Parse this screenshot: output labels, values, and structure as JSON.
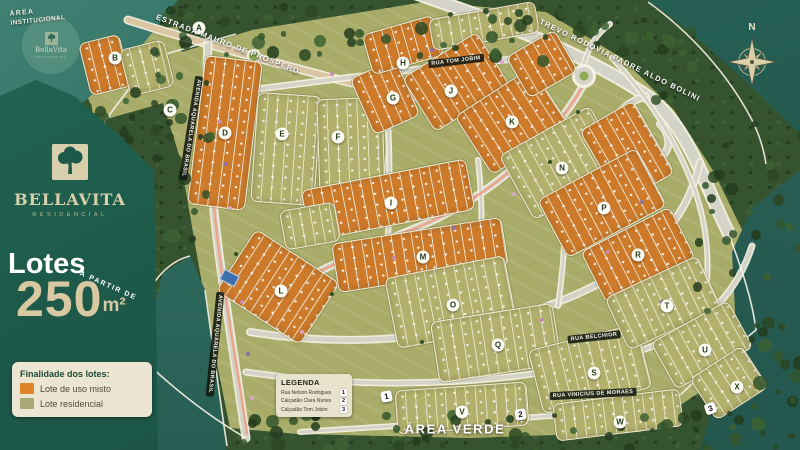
{
  "colors": {
    "panel_green": "#1d5848",
    "misto_orange": "#cd7a2b",
    "residencial_olive": "#b2b06c",
    "water_teal": "#2c685e",
    "cream": "#ece5d1",
    "beige_text": "#d9c9a2",
    "salmon_path": "#efa189"
  },
  "brand": {
    "name": "BellaVita",
    "subtitle": "RESIDENCIAL"
  },
  "offer": {
    "lead": "Lotes",
    "qualifier": "A PARTIR DE",
    "value": "250",
    "unit": "m²"
  },
  "finalidade": {
    "title": "Finalidade dos lotes:",
    "items": [
      {
        "label": "Lote de uso misto",
        "type": "misto"
      },
      {
        "label": "Lote residencial",
        "type": "residencial"
      }
    ]
  },
  "legenda": {
    "title": "LEGENDA",
    "items": [
      {
        "num": "1",
        "label": "Rua Nelson Rodrigues"
      },
      {
        "num": "2",
        "label": "Calçadão Clara Nunes"
      },
      {
        "num": "3",
        "label": "Calçadão Tom Jobim"
      }
    ]
  },
  "corner_labels": {
    "area_institucional_line1": "ÁREA",
    "area_institucional_line2": "INSTITUCIONAL",
    "area_verde": "ÁREA VERDE",
    "compass_north": "N"
  },
  "street_labels": [
    {
      "text": "ESTRADA MAURO DE PROSPERO",
      "x": 228,
      "y": 44,
      "rot": 21,
      "variant": "outline"
    },
    {
      "text": "TREVO RODOVIA PADRE ALDO BOLINI",
      "x": 620,
      "y": 60,
      "rot": 26,
      "variant": "outline"
    },
    {
      "text": "AVENIDA AQUARELA DO BRASIL",
      "x": 191,
      "y": 128,
      "rot": 99,
      "variant": "pill"
    },
    {
      "text": "AVENIDA AQUARELA DO BRASIL",
      "x": 215,
      "y": 344,
      "rot": 96,
      "variant": "pill"
    },
    {
      "text": "RUA TOM JOBIM",
      "x": 456,
      "y": 61,
      "rot": -7,
      "variant": "pill"
    },
    {
      "text": "RUA BELCHIOR",
      "x": 594,
      "y": 337,
      "rot": -6,
      "variant": "pill"
    },
    {
      "text": "RUA VINICIUS DE MORAES",
      "x": 593,
      "y": 394,
      "rot": -3,
      "variant": "pill"
    }
  ],
  "blocks": [
    {
      "letter": "A",
      "x": 199,
      "y": 28
    },
    {
      "letter": "B",
      "x": 115,
      "y": 58
    },
    {
      "letter": "C",
      "x": 170,
      "y": 110
    },
    {
      "letter": "D",
      "x": 225,
      "y": 133
    },
    {
      "letter": "E",
      "x": 282,
      "y": 134
    },
    {
      "letter": "F",
      "x": 338,
      "y": 137
    },
    {
      "letter": "G",
      "x": 393,
      "y": 98
    },
    {
      "letter": "H",
      "x": 403,
      "y": 63
    },
    {
      "letter": "I",
      "x": 391,
      "y": 203
    },
    {
      "letter": "J",
      "x": 451,
      "y": 91
    },
    {
      "letter": "K",
      "x": 512,
      "y": 122
    },
    {
      "letter": "L",
      "x": 281,
      "y": 291
    },
    {
      "letter": "M",
      "x": 423,
      "y": 257
    },
    {
      "letter": "N",
      "x": 562,
      "y": 168
    },
    {
      "letter": "O",
      "x": 453,
      "y": 305
    },
    {
      "letter": "P",
      "x": 604,
      "y": 208
    },
    {
      "letter": "Q",
      "x": 498,
      "y": 345
    },
    {
      "letter": "R",
      "x": 638,
      "y": 255
    },
    {
      "letter": "S",
      "x": 594,
      "y": 373
    },
    {
      "letter": "T",
      "x": 667,
      "y": 306
    },
    {
      "letter": "U",
      "x": 705,
      "y": 350
    },
    {
      "letter": "V",
      "x": 462,
      "y": 412
    },
    {
      "letter": "W",
      "x": 620,
      "y": 422
    },
    {
      "letter": "X",
      "x": 737,
      "y": 387
    }
  ],
  "markers": [
    {
      "num": "1",
      "x": 386,
      "y": 396,
      "rot": -10
    },
    {
      "num": "2",
      "x": 520,
      "y": 414,
      "rot": -8
    },
    {
      "num": "3",
      "x": 710,
      "y": 408,
      "rot": -20
    }
  ],
  "lot_areas": [
    {
      "x": 84,
      "y": 38,
      "w": 40,
      "h": 52,
      "rot": -14,
      "type": "misto"
    },
    {
      "x": 124,
      "y": 44,
      "w": 44,
      "h": 46,
      "rot": -14,
      "type": "residencial"
    },
    {
      "x": 196,
      "y": 58,
      "w": 56,
      "h": 148,
      "rot": 7,
      "type": "misto"
    },
    {
      "x": 254,
      "y": 94,
      "w": 62,
      "h": 108,
      "rot": 4,
      "type": "residencial"
    },
    {
      "x": 318,
      "y": 98,
      "w": 64,
      "h": 102,
      "rot": -2,
      "type": "residencial"
    },
    {
      "x": 360,
      "y": 66,
      "w": 48,
      "h": 60,
      "rot": -24,
      "type": "misto"
    },
    {
      "x": 366,
      "y": 24,
      "w": 72,
      "h": 40,
      "rot": -16,
      "type": "misto"
    },
    {
      "x": 430,
      "y": 10,
      "w": 106,
      "h": 30,
      "rot": -10,
      "type": "residencial"
    },
    {
      "x": 412,
      "y": 50,
      "w": 86,
      "h": 62,
      "rot": -32,
      "type": "misto"
    },
    {
      "x": 466,
      "y": 86,
      "w": 90,
      "h": 68,
      "rot": -33,
      "type": "misto"
    },
    {
      "x": 514,
      "y": 40,
      "w": 54,
      "h": 46,
      "rot": -30,
      "type": "misto"
    },
    {
      "x": 510,
      "y": 126,
      "w": 102,
      "h": 72,
      "rot": -29,
      "type": "residencial"
    },
    {
      "x": 596,
      "y": 110,
      "w": 60,
      "h": 82,
      "rot": -30,
      "type": "misto"
    },
    {
      "x": 546,
      "y": 170,
      "w": 110,
      "h": 64,
      "rot": -28,
      "type": "misto"
    },
    {
      "x": 588,
      "y": 226,
      "w": 98,
      "h": 56,
      "rot": -27,
      "type": "misto"
    },
    {
      "x": 304,
      "y": 174,
      "w": 166,
      "h": 50,
      "rot": -11,
      "type": "misto"
    },
    {
      "x": 334,
      "y": 230,
      "w": 170,
      "h": 48,
      "rot": -9,
      "type": "misto"
    },
    {
      "x": 228,
      "y": 250,
      "w": 98,
      "h": 72,
      "rot": 33,
      "type": "misto"
    },
    {
      "x": 390,
      "y": 266,
      "w": 120,
      "h": 70,
      "rot": -11,
      "type": "residencial"
    },
    {
      "x": 434,
      "y": 312,
      "w": 122,
      "h": 60,
      "rot": -9,
      "type": "residencial"
    },
    {
      "x": 396,
      "y": 386,
      "w": 130,
      "h": 42,
      "rot": -4,
      "type": "residencial"
    },
    {
      "x": 534,
      "y": 336,
      "w": 110,
      "h": 64,
      "rot": -14,
      "type": "residencial"
    },
    {
      "x": 612,
      "y": 274,
      "w": 100,
      "h": 56,
      "rot": -25,
      "type": "residencial"
    },
    {
      "x": 658,
      "y": 318,
      "w": 86,
      "h": 52,
      "rot": -29,
      "type": "residencial"
    },
    {
      "x": 554,
      "y": 396,
      "w": 126,
      "h": 36,
      "rot": -7,
      "type": "residencial"
    },
    {
      "x": 698,
      "y": 358,
      "w": 60,
      "h": 48,
      "rot": -33,
      "type": "residencial"
    },
    {
      "x": 282,
      "y": 206,
      "w": 54,
      "h": 38,
      "rot": -10,
      "type": "residencial"
    }
  ]
}
